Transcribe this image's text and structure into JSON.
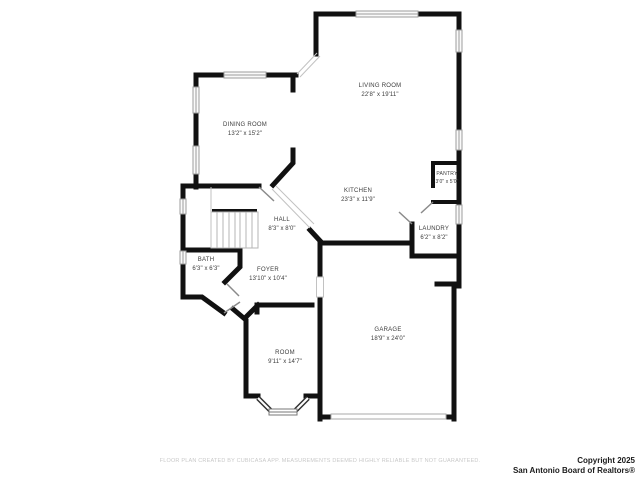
{
  "plan": {
    "rooms": [
      {
        "id": "living-room",
        "name": "LIVING ROOM",
        "dims": "22'8\" x 19'11\""
      },
      {
        "id": "dining-room",
        "name": "DINING ROOM",
        "dims": "13'2\" x 15'2\""
      },
      {
        "id": "kitchen",
        "name": "KITCHEN",
        "dims": "23'3\" x 11'9\""
      },
      {
        "id": "pantry",
        "name": "PANTRY",
        "dims": "3'0\" x 5'0\""
      },
      {
        "id": "laundry",
        "name": "LAUNDRY",
        "dims": "6'2\" x 8'2\""
      },
      {
        "id": "hall",
        "name": "HALL",
        "dims": "8'3\" x 8'0\""
      },
      {
        "id": "bath",
        "name": "BATH",
        "dims": "6'3\" x 6'3\""
      },
      {
        "id": "foyer",
        "name": "FOYER",
        "dims": "13'10\" x 10'4\""
      },
      {
        "id": "room",
        "name": "ROOM",
        "dims": "9'11\" x 14'7\""
      },
      {
        "id": "garage",
        "name": "GARAGE",
        "dims": "18'9\" x 24'0\""
      }
    ]
  },
  "footer": {
    "disclaimer": "FLOOR PLAN CREATED BY CUBICASA APP. MEASUREMENTS DEEMED HIGHLY RELIABLE BUT NOT GUARANTEED.",
    "copyright_line1": "Copyright 2025",
    "copyright_line2": "San Antonio Board of Realtors®"
  },
  "colors": {
    "wall": "#111111",
    "window_stroke": "#9c9c9c",
    "thin_line": "#c2c2c2",
    "label_text": "#3c3c3c",
    "disclaimer_text": "#c9c9c9",
    "copyright_text": "#1c1c1c",
    "background": "#ffffff"
  }
}
